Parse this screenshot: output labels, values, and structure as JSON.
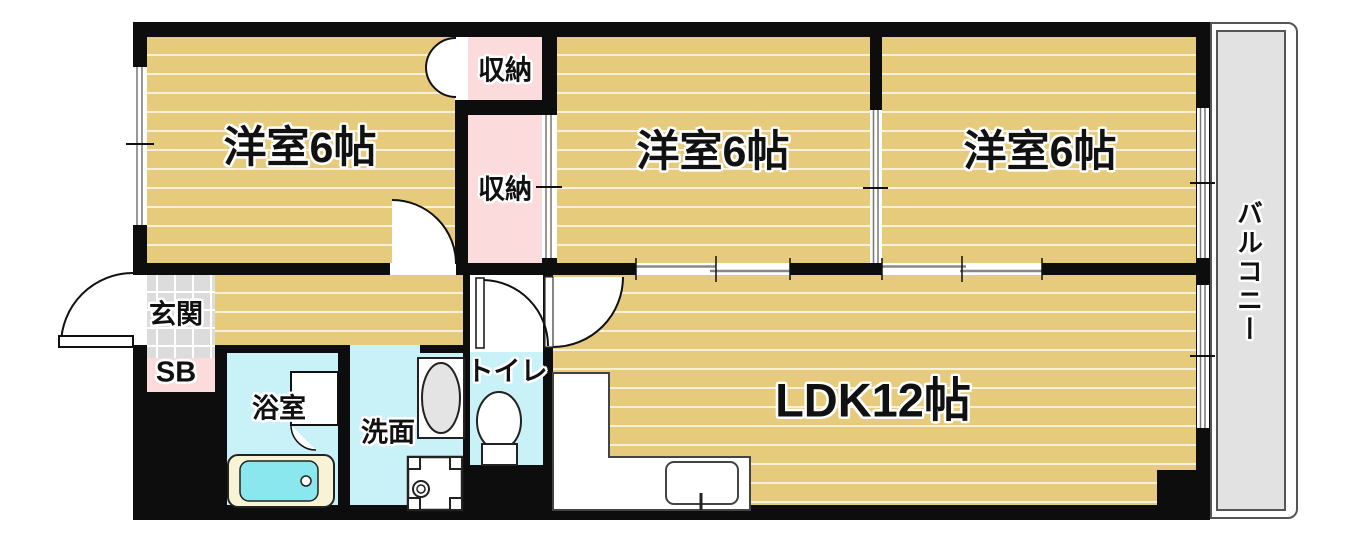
{
  "figure_type": "apartment-floor-plan",
  "palette": {
    "floor_wood": "#e7cb7c",
    "wall": "#0d0d0d",
    "closet_pink": "#fbdbdb",
    "wet_area_cyan": "#c9f2f8",
    "entrance_tile_gray": "#dcdcdc",
    "balcony_gray": "#e2e2e2",
    "bathtub_inner": "#8be7ee",
    "bathtub_rim": "#f7f3d4"
  },
  "rooms": {
    "room1": {
      "label": "洋室6帖"
    },
    "room2": {
      "label": "洋室6帖"
    },
    "room3": {
      "label": "洋室6帖"
    },
    "ldk": {
      "label": "LDK12帖"
    },
    "closet1": {
      "label": "収納"
    },
    "closet2": {
      "label": "収納"
    },
    "balcony": {
      "label": "バルコニー"
    },
    "entrance": {
      "label": "玄関"
    },
    "shoe_box": {
      "label": "SB"
    },
    "bath": {
      "label": "浴室"
    },
    "washroom": {
      "label": "洗面"
    },
    "toilet": {
      "label": "トイレ"
    }
  }
}
